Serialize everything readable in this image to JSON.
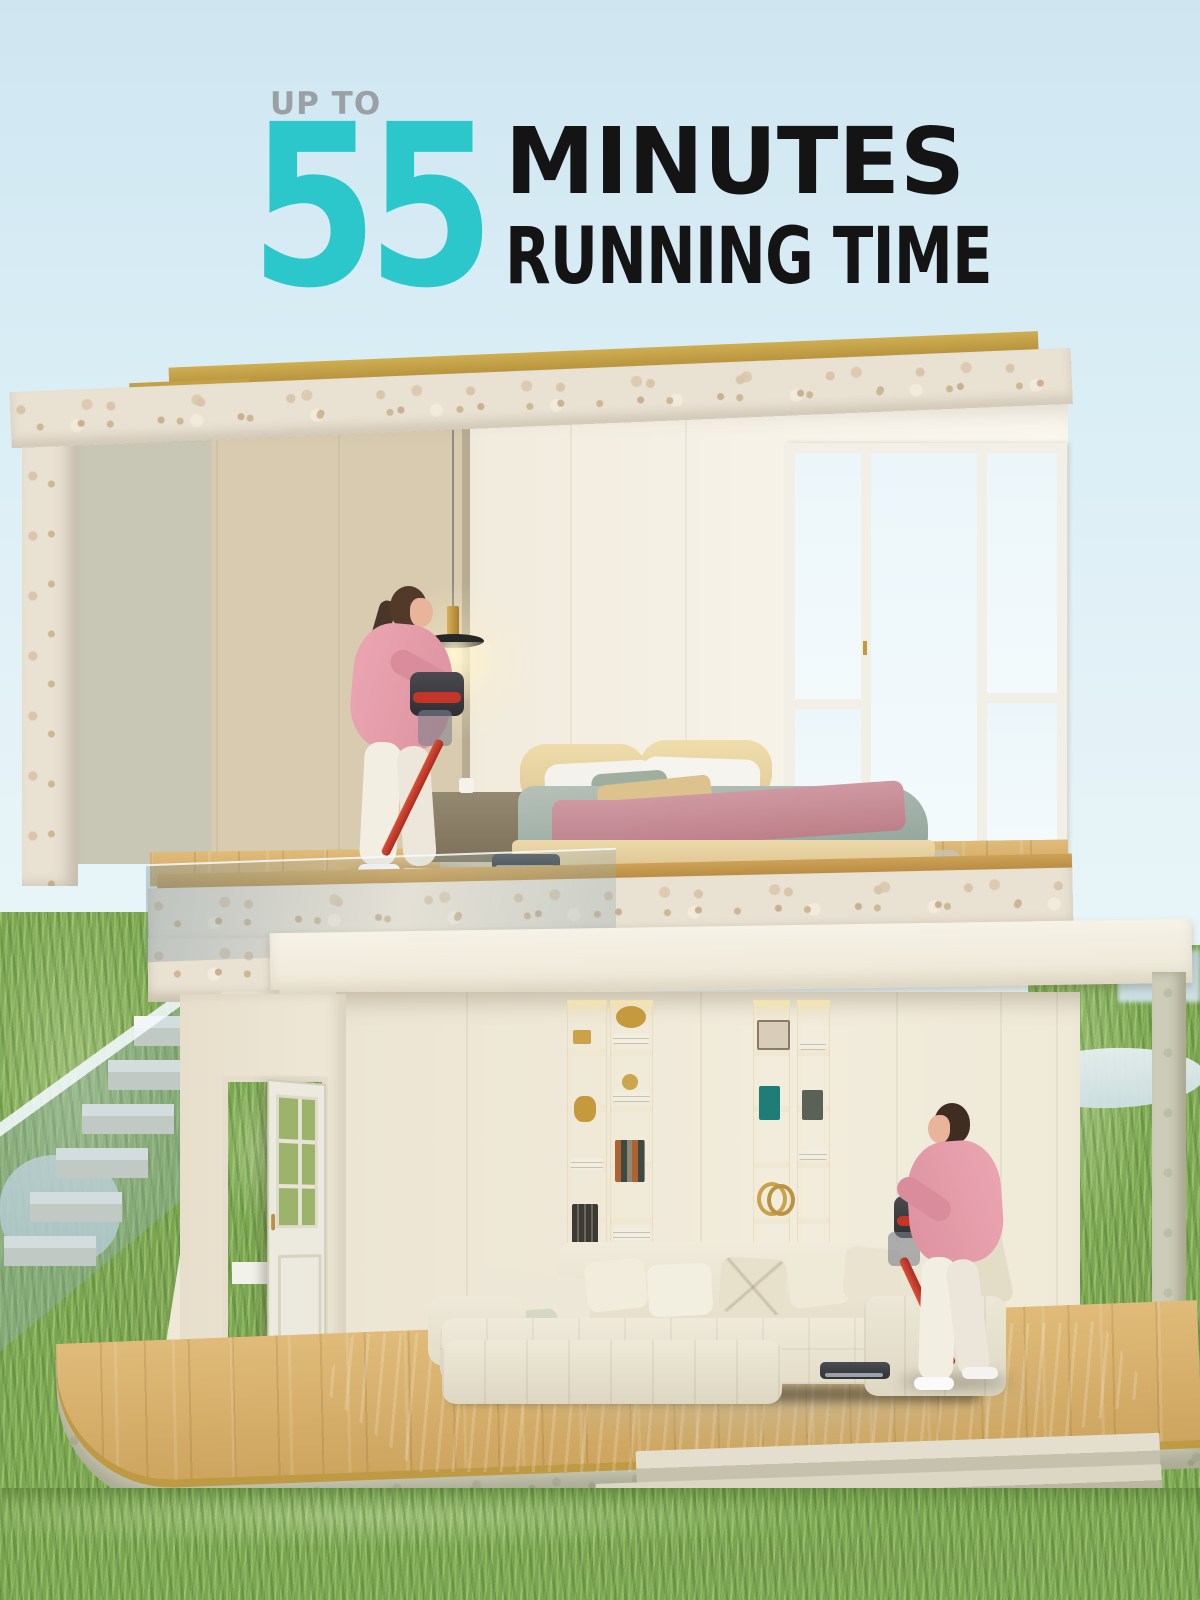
{
  "headline": {
    "kicker": "UP TO",
    "number": "55",
    "line1": "MINUTES",
    "line2": "RUNNING TIME"
  },
  "colors": {
    "accent_teal": "#2bc7cb",
    "headline_black": "#141414",
    "kicker_gray": "#9aa0a4",
    "sky_top": "#cfe6f1",
    "sky_bottom": "#edf7f7",
    "roof_gold_trim": "#c2a148",
    "terrazzo_stone": "#e9e1d2",
    "wall_cream": "#efe8d8",
    "wood_floor": "#d7b26c",
    "grass_green": "#7aa64f",
    "sofa_cream": "#ebe6d4",
    "bed_duvet_sage": "#a5b3aa",
    "bed_throw_pink": "#c78f97",
    "vacuum_red": "#c23a2c",
    "vacuum_dark": "#3c3c42",
    "shirt_pink": "#e59aa7",
    "pants_cream": "#f2eee2"
  }
}
